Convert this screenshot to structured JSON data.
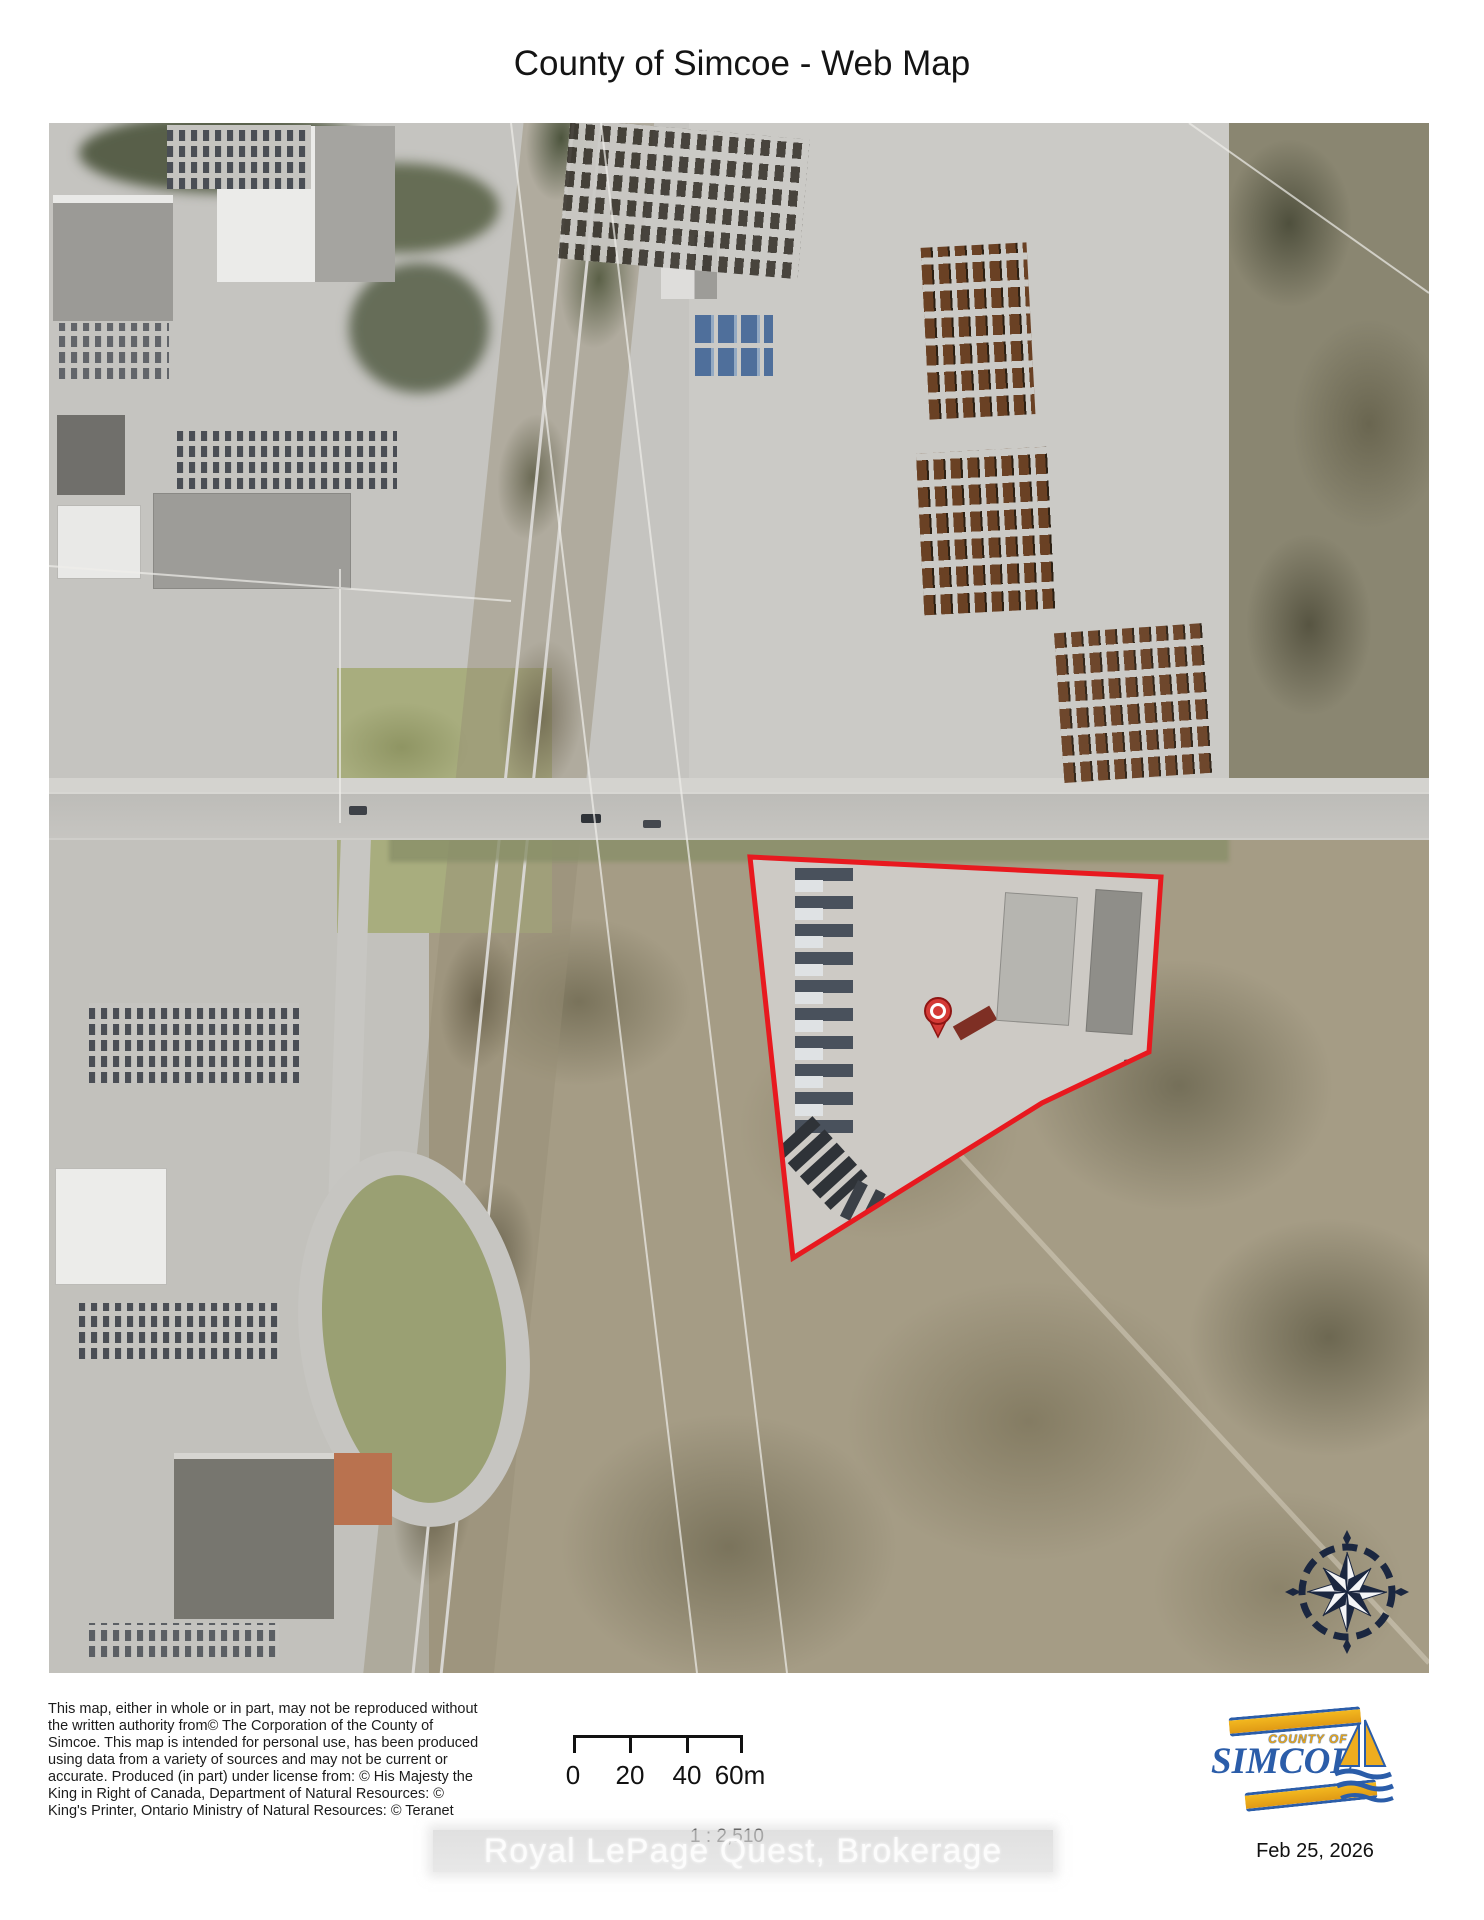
{
  "title": "County of Simcoe - Web Map",
  "map": {
    "parcel_outline_color": "#e8191f",
    "pin_color": "#d43a36",
    "compass_color": "#1b2740"
  },
  "footer": {
    "disclaimer_lines": [
      "This map, either in whole or in part, may not be reproduced without",
      "the written authority from© The Corporation of the County of",
      "Simcoe. This map is intended for personal use, has been produced",
      "using data from a variety of sources and may not be current or",
      "accurate. Produced (in part) under license from: © His Majesty the",
      "King in Right of Canada, Department of Natural Resources: ©",
      "King's Printer, Ontario Ministry of Natural Resources: © Teranet"
    ],
    "scale_bar": {
      "labels": [
        "0",
        "20",
        "40",
        "60m"
      ]
    },
    "scale_ratio": "1 : 2,510",
    "watermark": "Royal LePage Quest, Brokerage",
    "logo": {
      "top_text": "COUNTY OF",
      "name": "SIMCOE",
      "blue": "#2b5da9",
      "gold": "#eead1f"
    },
    "date": "Feb 25, 2026"
  }
}
